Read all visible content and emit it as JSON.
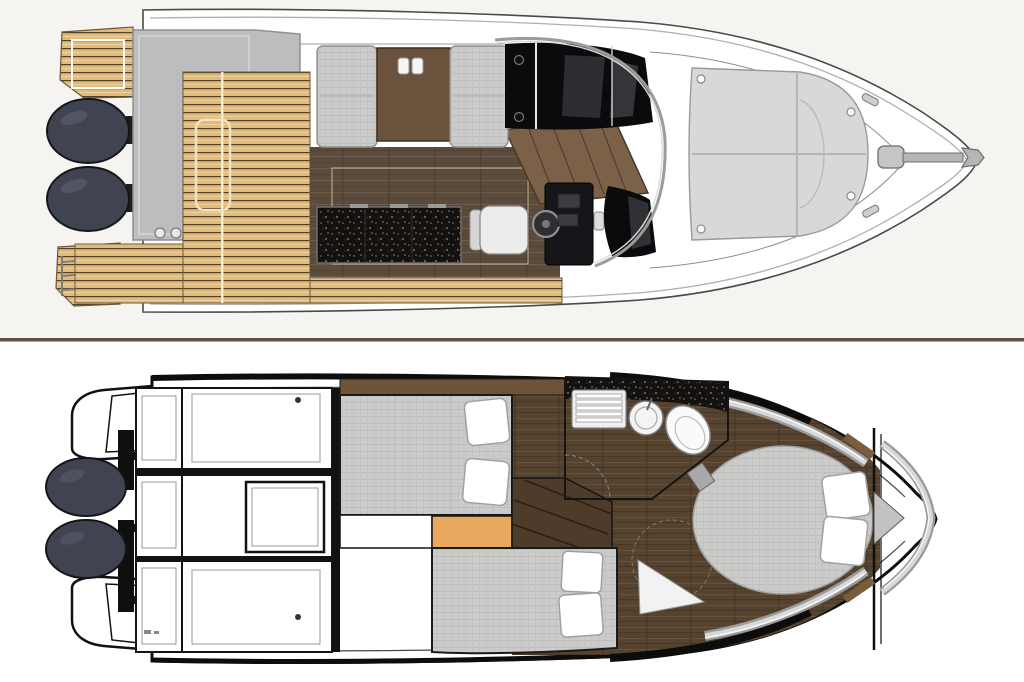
{
  "meta": {
    "title": "Motor yacht two-deck floor plan illustration",
    "type": "boat-floor-plan",
    "text_visible": "none"
  },
  "colors": {
    "background_top": "#f6f4f1",
    "background_bottom": "#ffffff",
    "divider": "#5f5244",
    "hull_fill": "#ffffff",
    "hull_outline_light": "#4a4a4a",
    "hull_outline_heavy": "#0d0d0d",
    "teak": "#e2ba7a",
    "teak_line": "#53422a",
    "wood_main": "#5b4b3c",
    "wood_lower": "#55432f",
    "table_wood": "#6a523c",
    "stairs_wood": "#7a6148",
    "fabric_gray": "#cbcbca",
    "sunpad_gray": "#d8d8d7",
    "engine": "#3f4450",
    "counter_black": "#141210",
    "glazing_black": "#0b0b0d",
    "orange_step": "#e9a85e",
    "chrome_light": "#d8d8d8",
    "pillow_white": "#ffffff",
    "hatch_gray": "#bdbdbd"
  },
  "decks": {
    "main_deck": {
      "label": "Main deck plan",
      "regions": [
        "swim platforms",
        "twin outboard engines",
        "aft hatch",
        "teak cockpit",
        "salon settees with table",
        "galley counter",
        "helm console with wheel",
        "companionway stairs",
        "windshield glazing",
        "bow sunpad",
        "anchor"
      ]
    },
    "lower_deck": {
      "label": "Lower deck plan",
      "regions": [
        "twin outboard engines",
        "stern platform brackets",
        "storage lockers",
        "aft double berth with pillows",
        "step",
        "second berth with pillows",
        "companionway stairs",
        "head with sink and toilet",
        "owner cabin island bed",
        "bow locker"
      ]
    }
  }
}
